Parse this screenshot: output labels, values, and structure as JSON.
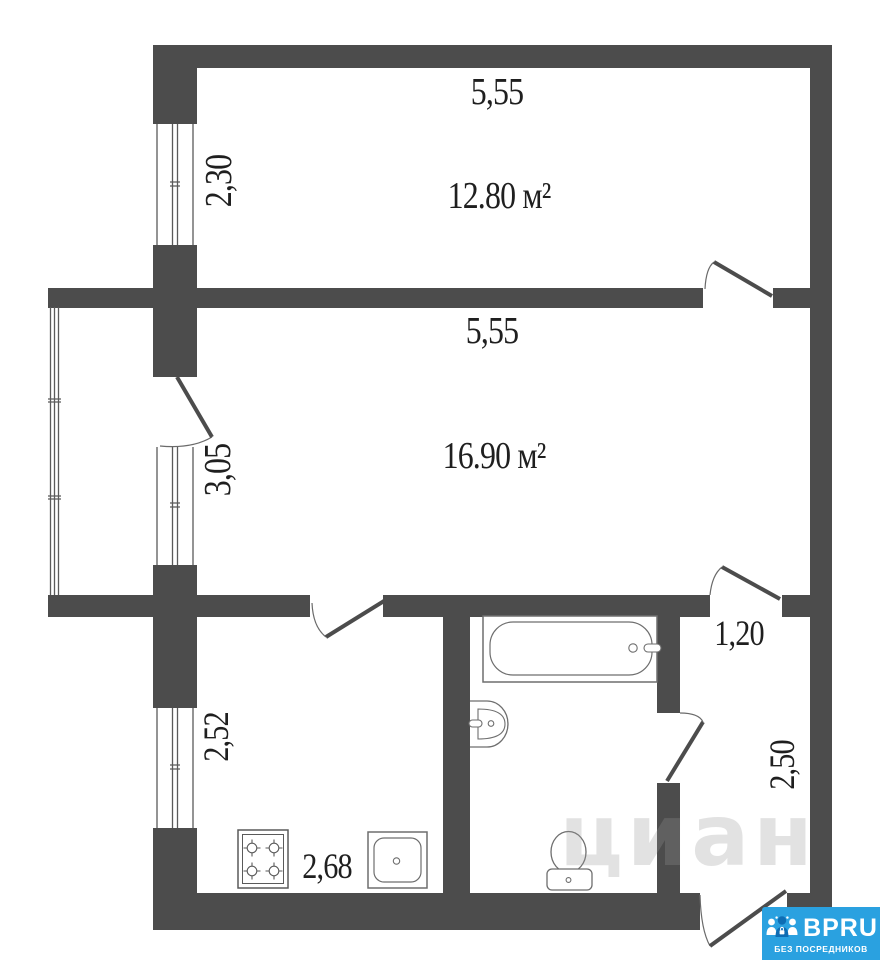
{
  "plan": {
    "rooms": {
      "top_room": {
        "area": "12.80 м²",
        "area_value": "12.80",
        "area_unit": "м",
        "width": "5,55",
        "depth": "2,30"
      },
      "middle_room": {
        "area": "16.90 м²",
        "area_value": "16.90",
        "area_unit": "м",
        "width": "5,55",
        "depth": "3,05"
      },
      "kitchen": {
        "width": "2,68",
        "depth": "2,52"
      },
      "hallway": {
        "width": "1,20",
        "depth": "2,50"
      }
    }
  },
  "watermark_text": "циан",
  "logo": {
    "brand": "BPRU",
    "tagline": "БЕЗ ПОСРЕДНИКОВ",
    "bg_color": "#2aa1e0",
    "icon": "people-lock-icon"
  },
  "colors": {
    "wall": "#4c4c4c",
    "fixture_line": "#6e6e6e",
    "door_line": "#4c4c4c",
    "text": "#1f1f1f"
  },
  "icons": {
    "bathtub": "bathtub-icon",
    "washbasin": "washbasin-icon",
    "toilet": "toilet-icon",
    "stove": "stove-icon",
    "kitchen_sink": "kitchen-sink-icon",
    "logo_people": "people-lock-icon"
  }
}
